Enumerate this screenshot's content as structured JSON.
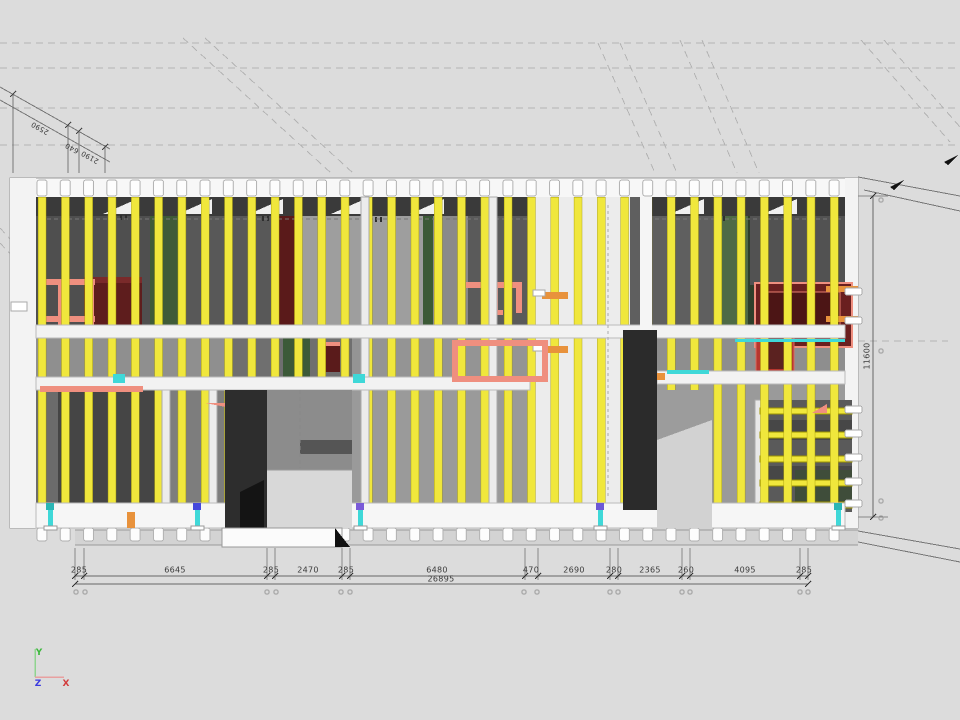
{
  "viewport": {
    "description": "CAD 3D model view of timber framed wall elevation with dimensions"
  },
  "dimensions": {
    "bottom_segments": [
      "285",
      "6645",
      "285",
      "2470",
      "285",
      "6480",
      "470",
      "2690",
      "280",
      "2365",
      "260",
      "4095",
      "285"
    ],
    "bottom_total": "26895",
    "right_height": "11600",
    "top_left_segments": [
      "2590",
      "640",
      "2190"
    ]
  },
  "axis_triad": {
    "x": "X",
    "y": "Y",
    "z": "Z"
  },
  "palette": {
    "background": "#dcdcdc",
    "frame_white": "#f7f7f7",
    "stud_yellow": "#f0e73c",
    "panel_dark_gray": "#4f4f4f",
    "panel_green": "#3f5b38",
    "panel_maroon": "#5a1a1a",
    "pipe_salmon": "#ef8f7f",
    "block_orange": "#e8923c",
    "anchor_cyan": "#3fd8d8",
    "axis_x_red": "#d23b3b",
    "axis_y_green": "#3db83d",
    "axis_z_blue": "#3a3adf"
  }
}
